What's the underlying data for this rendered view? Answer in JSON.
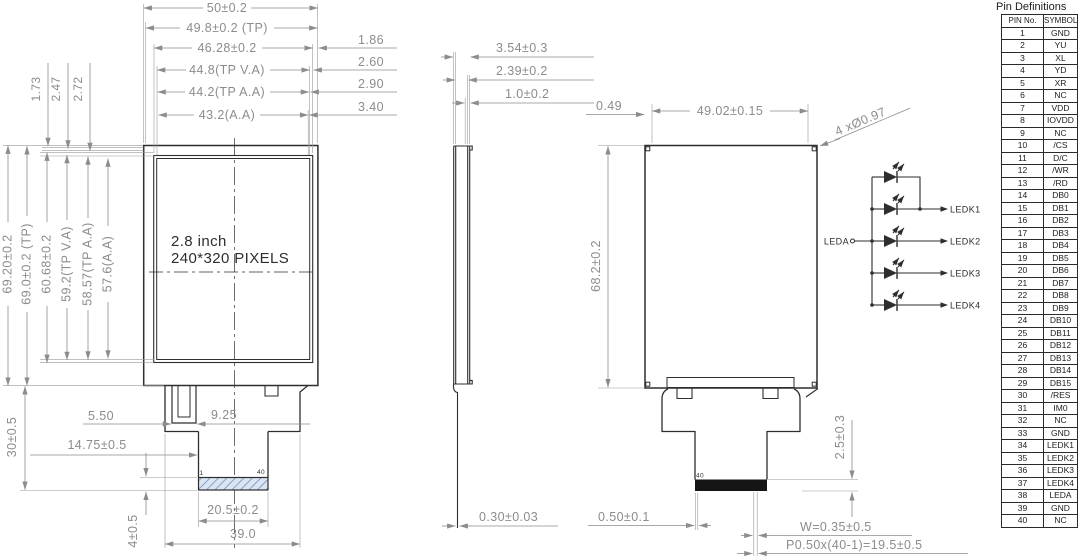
{
  "front_view": {
    "screen_label_line1": "2.8 inch",
    "screen_label_line2": "240*320 PIXELS",
    "dims_top": [
      "50±0.2",
      "49.8±0.2 (TP)",
      "46.28±0.2",
      "44.8(TP V.A)",
      "44.2(TP A.A)",
      "43.2(A.A)"
    ],
    "dims_top_gaps": [
      "1.86",
      "2.60",
      "2.90",
      "3.40"
    ],
    "dims_left": [
      "69.20±0.2",
      "69.0±0.2 (TP)",
      "60.68±0.2",
      "59.2(TP V.A)",
      "58.57(TP A.A)",
      "57.6(A.A)"
    ],
    "dims_left_small": [
      "1.73",
      "2.47",
      "2.72"
    ],
    "dim_slot": "5.50",
    "dim_tab": "9.25",
    "dim_tail_offset": "14.75±0.5",
    "dim_tail_height": "30±0.5",
    "dim_contact_height": "4±0.5",
    "dim_contact_width": "20.5±0.2",
    "dim_tail_width": "39.0",
    "pin1_label": "1",
    "pin40_label": "40"
  },
  "side_view": {
    "dim_total_thickness": "3.54±0.3",
    "dim_mid_thickness": "2.39±0.2",
    "dim_top_thickness": "1.0±0.2",
    "dim_fpc_thickness": "0.30±0.03"
  },
  "back_view": {
    "dim_hole_offset": "0.49",
    "dim_hole_pitch": "49.02±0.15",
    "dim_height": "68.2±0.2",
    "holes_note": "4 xØ0.97",
    "dim_contact_exposed": "2.5±0.3",
    "dim_pin_offset": "0.50±0.1",
    "dim_pin_width": "W=0.35±0.5",
    "dim_pitch": "P0.50x(40-1)=19.5±0.5",
    "pin40_label": "40"
  },
  "led_circuit": {
    "anode_label": "LEDA",
    "cathode_labels": [
      "LEDK1",
      "LEDK2",
      "LEDK3",
      "LEDK4"
    ]
  },
  "pin_table": {
    "title": "Pin Definitions",
    "headers": [
      "PIN No.",
      "SYMBOL"
    ],
    "rows": [
      [
        "1",
        "GND"
      ],
      [
        "2",
        "YU"
      ],
      [
        "3",
        "XL"
      ],
      [
        "4",
        "YD"
      ],
      [
        "5",
        "XR"
      ],
      [
        "6",
        "NC"
      ],
      [
        "7",
        "VDD"
      ],
      [
        "8",
        "IOVDD"
      ],
      [
        "9",
        "NC"
      ],
      [
        "10",
        "/CS"
      ],
      [
        "11",
        "D/C"
      ],
      [
        "12",
        "/WR"
      ],
      [
        "13",
        "/RD"
      ],
      [
        "14",
        "DB0"
      ],
      [
        "15",
        "DB1"
      ],
      [
        "16",
        "DB2"
      ],
      [
        "17",
        "DB3"
      ],
      [
        "18",
        "DB4"
      ],
      [
        "19",
        "DB5"
      ],
      [
        "20",
        "DB6"
      ],
      [
        "21",
        "DB7"
      ],
      [
        "22",
        "DB8"
      ],
      [
        "23",
        "DB9"
      ],
      [
        "24",
        "DB10"
      ],
      [
        "25",
        "DB11"
      ],
      [
        "26",
        "DB12"
      ],
      [
        "27",
        "DB13"
      ],
      [
        "28",
        "DB14"
      ],
      [
        "29",
        "DB15"
      ],
      [
        "30",
        "/RES"
      ],
      [
        "31",
        "IM0"
      ],
      [
        "32",
        "NC"
      ],
      [
        "33",
        "GND"
      ],
      [
        "34",
        "LEDK1"
      ],
      [
        "35",
        "LEDK2"
      ],
      [
        "36",
        "LEDK3"
      ],
      [
        "37",
        "LEDK4"
      ],
      [
        "38",
        "LEDA"
      ],
      [
        "39",
        "GND"
      ],
      [
        "40",
        "NC"
      ]
    ]
  },
  "colors": {
    "line": "#2e2e2e",
    "dim": "#8c8c8c",
    "hatch_fill": "#dbe5f2",
    "hatch_stroke": "#6f8cc0",
    "connector_fill": "#141414"
  }
}
